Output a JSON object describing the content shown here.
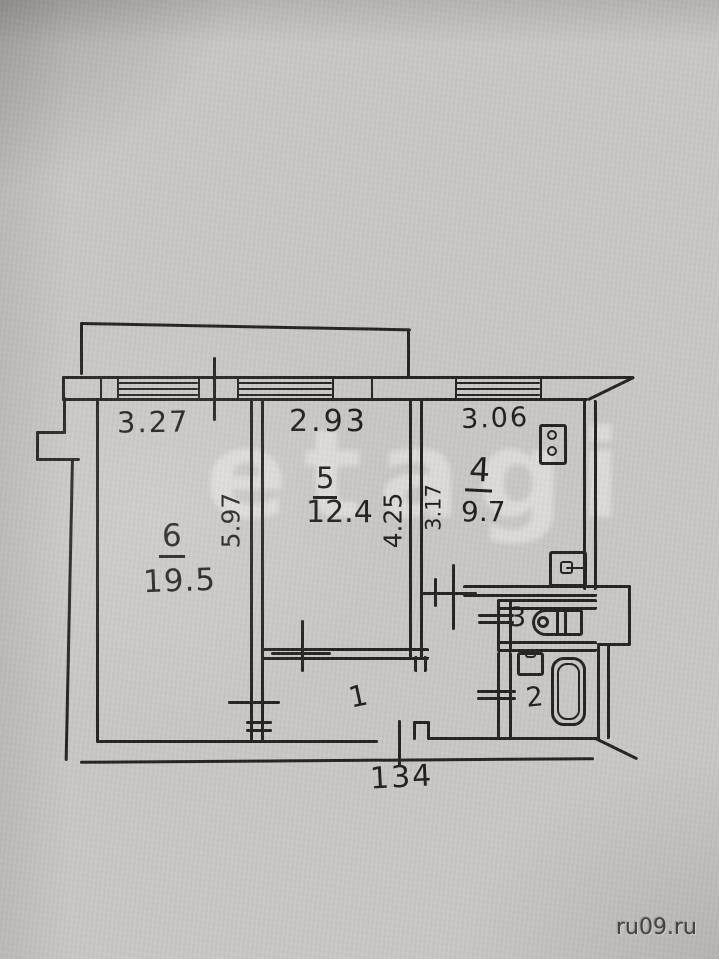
{
  "photo": {
    "watermark_center": "etagi",
    "watermark_site": "ru09.ru"
  },
  "plan": {
    "dims": {
      "window_left": "3.27",
      "window_mid": "2.93",
      "window_right": "3.06",
      "depth_left": "5.97",
      "depth_mid": "4.25",
      "depth_small": "3.17",
      "entrance": "134"
    },
    "rooms": {
      "living": {
        "number": "6",
        "area": "19.5"
      },
      "bedroom": {
        "number": "5",
        "area": "12.4"
      },
      "kitchen": {
        "number": "4",
        "area": "9.7"
      },
      "toilet": {
        "number": "3"
      },
      "bathroom": {
        "number": "2"
      },
      "hallway": {
        "number": "1"
      }
    }
  },
  "colors": {
    "ink": "#242120",
    "paper": "#cbc7c6",
    "watermark": "rgba(255,255,255,0.36)",
    "site_text": "#45423f"
  }
}
